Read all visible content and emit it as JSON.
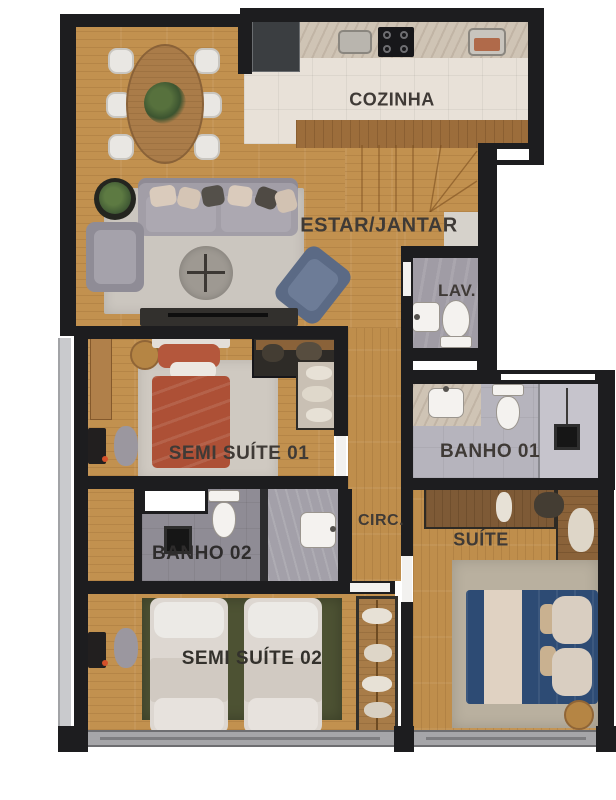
{
  "title": "Apartment floor plan",
  "rooms": {
    "cozinha": {
      "label": "COZINHA"
    },
    "estar_jantar": {
      "label": "ESTAR/JANTAR"
    },
    "lav": {
      "label": "LAV."
    },
    "semi_suite_01": {
      "label": "SEMI SUÍTE 01"
    },
    "banho_01": {
      "label": "BANHO 01"
    },
    "banho_02": {
      "label": "BANHO 02"
    },
    "circ": {
      "label": "CIRC."
    },
    "suite": {
      "label": "SUÍTE"
    },
    "semi_suite_02": {
      "label": "SEMI SUÍTE 02"
    }
  },
  "palette": {
    "wall": "#1d1d1f",
    "wood_floor": "#c2914f",
    "kitchen_tile": "#e8e1d8",
    "bath_tile_dark": "#8f8c95",
    "bath_tile_light": "#b6b4bd",
    "lav_tile": "#a09ca5",
    "rug_living": "#cbc6bf",
    "rug_green": "#4d5233",
    "rug_suite": "#b9b09f",
    "bed_terracotta": "#ad5036",
    "bed_blue": "#2f4e78",
    "bed_white": "#ddd7d1",
    "counter_marble": "#cfc4b5",
    "counter_wood": "#9c6d3b"
  },
  "furniture": {
    "estar_jantar": [
      "dining-table",
      "six-chairs",
      "plant",
      "sofa",
      "armchair",
      "accent-chair",
      "coffee-table",
      "rug",
      "tv-console"
    ],
    "cozinha": [
      "refrigerator",
      "sink",
      "cooktop",
      "second-sink",
      "counters",
      "stairs"
    ],
    "lav": [
      "washbasin",
      "toilet"
    ],
    "semi_suite_01": [
      "double-bed",
      "rug",
      "closet",
      "stool",
      "tv",
      "bench"
    ],
    "banho_01": [
      "vanity-washbasin",
      "toilet",
      "shower",
      "floor-drain"
    ],
    "banho_02": [
      "window",
      "toilet",
      "floor-drain",
      "shower",
      "washbasin"
    ],
    "circ": [],
    "suite": [
      "wardrobe",
      "double-bed",
      "rug",
      "side-table"
    ],
    "semi_suite_02": [
      "single-bed",
      "single-bed",
      "rug",
      "wardrobe",
      "tv",
      "bench"
    ]
  }
}
